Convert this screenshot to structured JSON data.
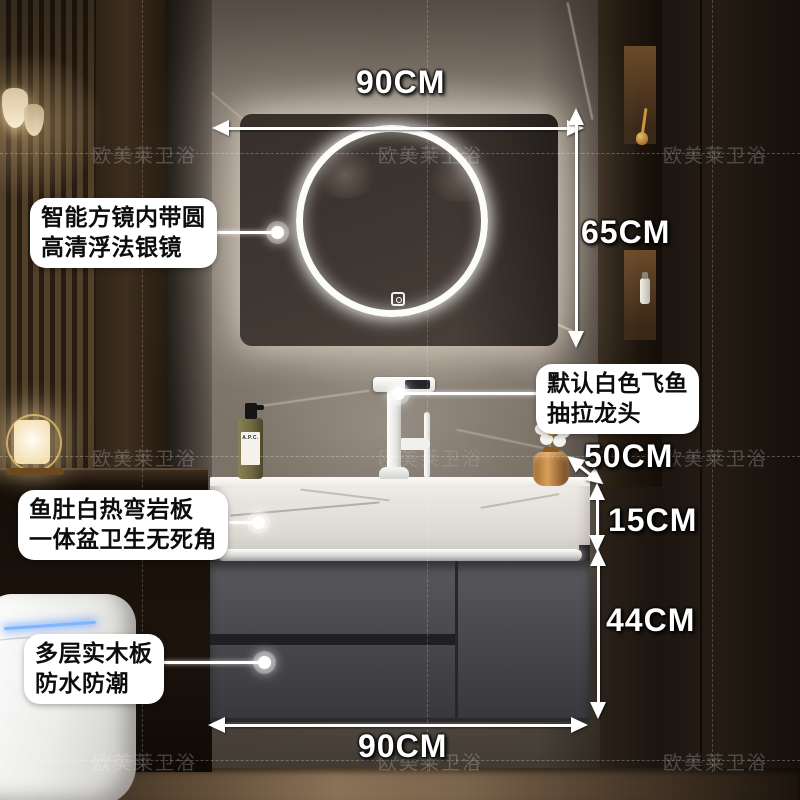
{
  "watermark": {
    "text": "欧美莱卫浴"
  },
  "dimensions": {
    "mirror_width": "90CM",
    "mirror_height": "65CM",
    "counter_depth": "50CM",
    "basin_height": "15CM",
    "cabinet_height": "44CM",
    "cabinet_width": "90CM"
  },
  "callouts": {
    "mirror": {
      "line1": "智能方镜内带圆",
      "line2": "高清浮法银镜"
    },
    "faucet": {
      "line1": "默认白色飞鱼",
      "line2": "抽拉龙头"
    },
    "basin": {
      "line1": "鱼肚白热弯岩板",
      "line2": "一体盆卫生无死角"
    },
    "cabinet": {
      "line1": "多层实木板",
      "line2": "防水防潮"
    }
  },
  "products": {
    "soap_bottle_label": "A.P.C."
  },
  "colors": {
    "annotation_white": "#ffffff",
    "callout_text": "#0d0d0d",
    "cabinet_grey": "#4a4a4e",
    "marble_slab_white": "#e9e6e1",
    "led_ring_white": "#fdfdf8",
    "toilet_led_blue": "#7fb4ff",
    "vase_gold": "#d89f58"
  }
}
